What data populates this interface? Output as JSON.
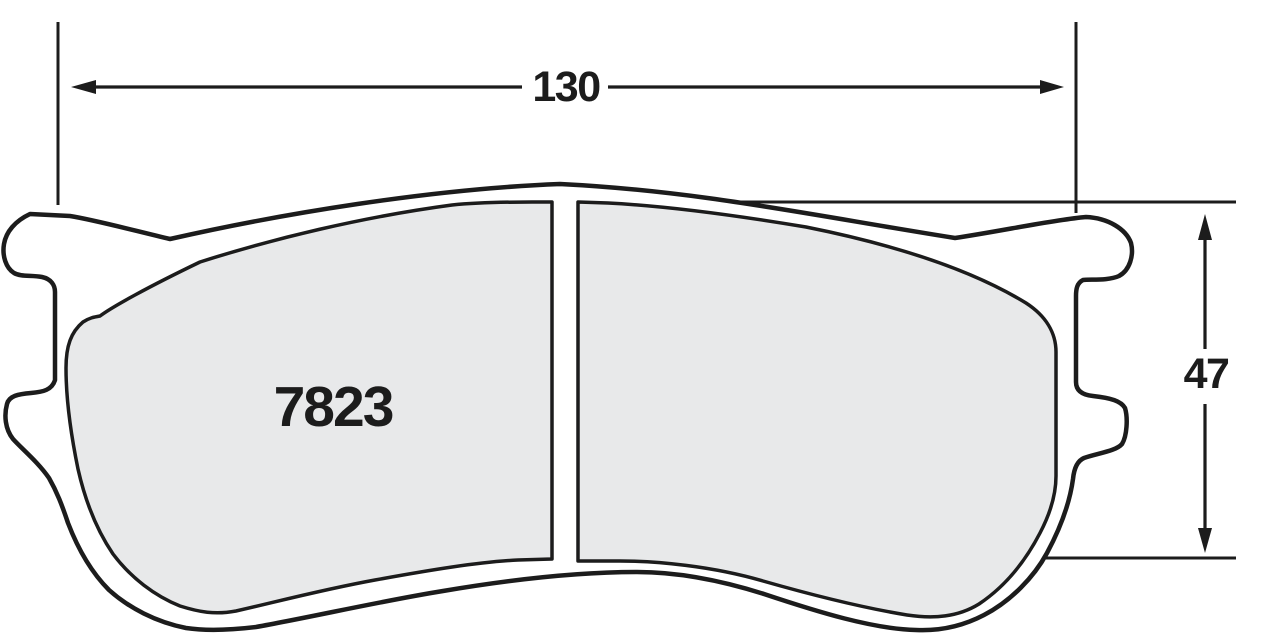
{
  "drawing": {
    "part_number": "7823",
    "dimensions": {
      "width": "130",
      "height": "47"
    },
    "colors": {
      "line": "#1c1c1c",
      "pad_fill": "#e8e9ea",
      "plate_fill": "#ffffff",
      "background": "#ffffff"
    }
  }
}
